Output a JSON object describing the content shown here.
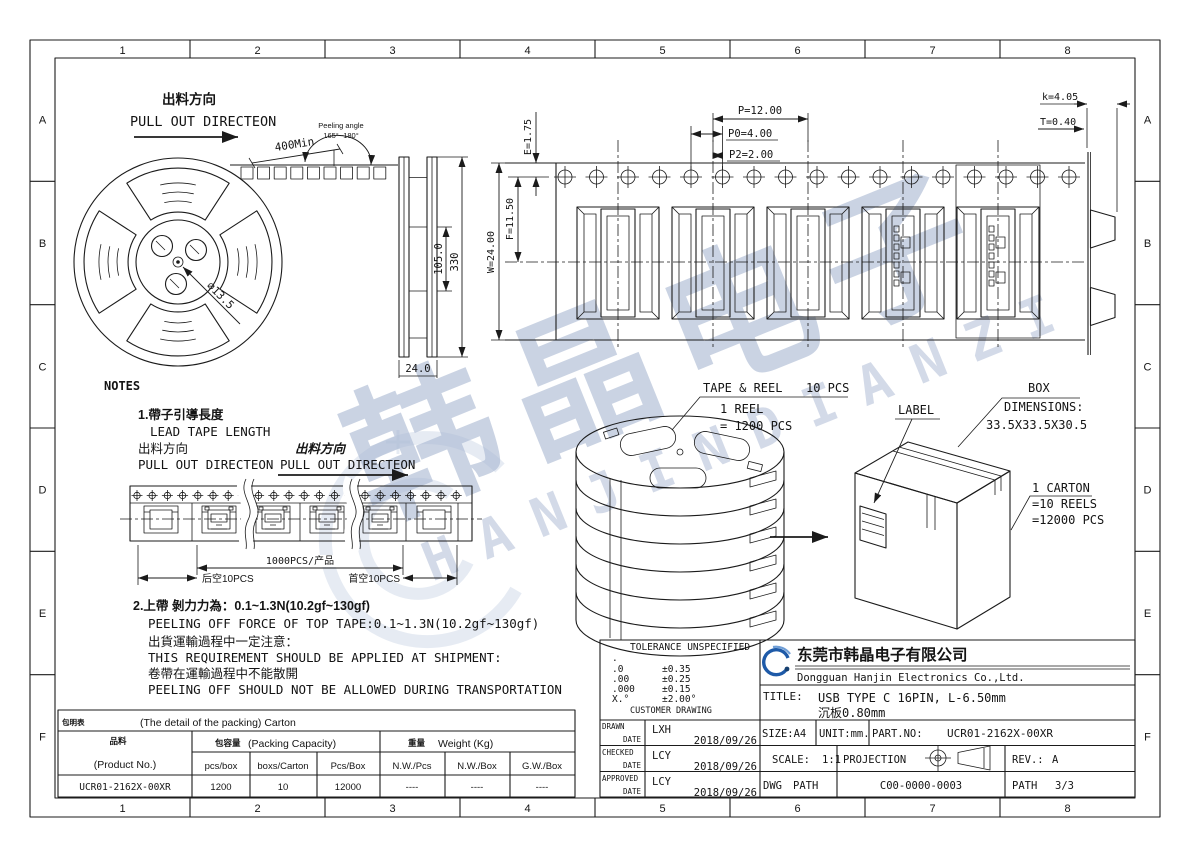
{
  "border": {
    "columns": [
      "1",
      "2",
      "3",
      "4",
      "5",
      "6",
      "7",
      "8"
    ],
    "rows": [
      "A",
      "B",
      "C",
      "D",
      "E",
      "F"
    ]
  },
  "colors": {
    "line": "#1b1b1b",
    "watermark": "#96a8c8",
    "logo_blue": "#1e5aa8"
  },
  "reel_view": {
    "pull_out_cn": "出料方向",
    "pull_out_en": "PULL OUT DIRECTEON",
    "leader_length": "400Min",
    "peeling_angle_label": "Peeling angle",
    "peeling_angle_value": "165°~180°",
    "hub_hole_dia": "∅13.5",
    "inner_width": "105.0",
    "outer_dia": "330",
    "tape_width": "24.0"
  },
  "tape_view": {
    "E": "E=1.75",
    "P": "P=12.00",
    "P0": "P0=4.00",
    "P2": "P2=2.00",
    "F": "F=11.50",
    "W": "W=24.00",
    "K": "k=4.05",
    "T": "T=0.40"
  },
  "notes": {
    "heading": "NOTES",
    "n1_cn": "1.帶子引導長度",
    "n1_en": "LEAD TAPE LENGTH",
    "n1_dir_cn": "出料方向",
    "n1_dir_en": "PULL OUT DIRECTEON",
    "n1_dir2_cn": "出料方向",
    "n1_dir2_en": "PULL OUT DIRECTEON",
    "strip_total": "1000PCS/产品",
    "strip_tail": "后空10PCS",
    "strip_head": "首空10PCS",
    "n2_cn": "2.上帶 剝力力為：0.1~1.3N(10.2gf~130gf)",
    "n2_en": "PEELING OFF FORCE OF TOP TAPE:0.1~1.3N(10.2gf~130gf)",
    "n2b_cn": "出貨運輸過程中一定注意：",
    "n2b_en": "THIS REQUIREMENT SHOULD BE APPLIED AT SHIPMENT:",
    "n2c_cn": "卷帶在運輸過程中不能散開",
    "n2c_en": "PEELING OFF SHOULD NOT BE ALLOWED DURING TRANSPORTATION"
  },
  "packing": {
    "tape_reel_label": "TAPE & REEL",
    "tape_reel_qty": "10 PCS",
    "reel_count": "1 REEL",
    "reel_qty": "= 1200 PCS",
    "label": "LABEL",
    "box": "BOX",
    "dims_label": "DIMENSIONS:",
    "dims_value": "33.5X33.5X30.5",
    "carton": "1 CARTON",
    "carton_reels": "=10 REELS",
    "carton_qty": "=12000 PCS"
  },
  "table": {
    "tag": "包明表",
    "heading": "(The detail of the packing) Carton",
    "product_cn": "品料",
    "product_en": "(Product No.)",
    "capacity_cn": "包容量",
    "capacity_en": "(Packing Capacity)",
    "weight_cn": "重量",
    "weight_en": "Weight (Kg)",
    "cols": [
      "pcs/box",
      "boxs/Carton",
      "Pcs/Box",
      "N.W./Pcs",
      "N.W./Box",
      "G.W./Box"
    ],
    "row": {
      "part": "UCR01-2162X-00XR",
      "values": [
        "1200",
        "10",
        "12000",
        "----",
        "----",
        "----"
      ]
    }
  },
  "title_block": {
    "tolerance_title": "TOLERANCE UNSPECIFIED",
    "tol_dot": ".",
    "tol": [
      {
        "l": ".0",
        "r": "±0.35"
      },
      {
        "l": ".00",
        "r": "±0.25"
      },
      {
        "l": ".000",
        "r": "±0.15"
      },
      {
        "l": "X.°",
        "r": "±2.00°"
      }
    ],
    "tolerance_footer": "CUSTOMER DRAWING",
    "company_cn": "东莞市韩晶电子有限公司",
    "company_en": "Dongguan Hanjin Electronics Co.,Ltd.",
    "title_label": "TITLE:",
    "title_line1": "USB TYPE C 16PIN, L-6.50mm",
    "title_line2": "沉板0.80mm",
    "drawn_label": "DRAWN",
    "checked_label": "CHECKED",
    "approved_label": "APPROVED",
    "date_label": "DATE",
    "drawn_by": "LXH",
    "drawn_date": "2018/09/26",
    "checked_by": "LCY",
    "checked_date": "2018/09/26",
    "approved_by": "LCY",
    "approved_date": "2018/09/26",
    "size": "SIZE:A4",
    "unit": "UNIT:mm.",
    "part_label": "PART.NO:",
    "part_no": "UCR01-2162X-00XR",
    "scale_label": "SCALE:",
    "scale": "1:1",
    "projection": "PROJECTION",
    "rev_label": "REV.:",
    "rev": "A",
    "dwg": "DWG",
    "path": "PATH",
    "dwg_no": "C00-0000-0003",
    "sheet_label": "PATH",
    "sheet": "3/3"
  },
  "watermark": {
    "cn": "韩晶电子",
    "en": "HANJINDIANZI"
  }
}
